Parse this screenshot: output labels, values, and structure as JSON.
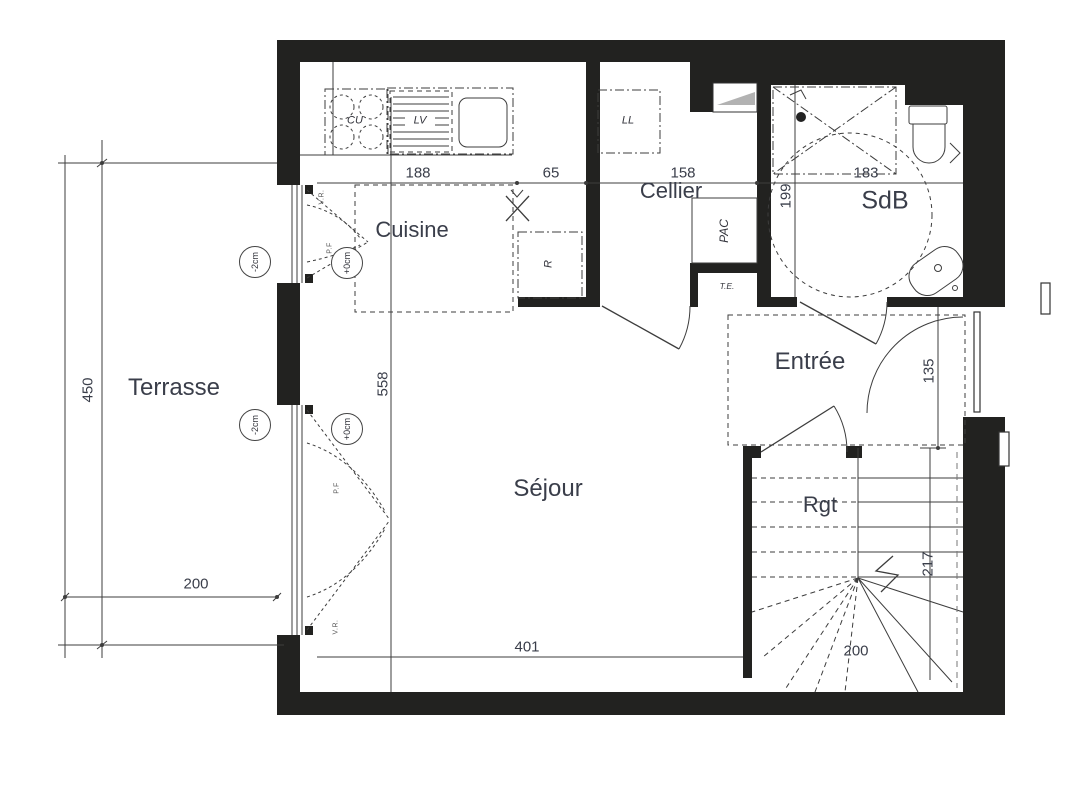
{
  "rooms": {
    "terrasse": "Terrasse",
    "cuisine": "Cuisine",
    "cellier": "Cellier",
    "sdb": "SdB",
    "sejour": "Séjour",
    "entree": "Entrée",
    "rgt": "Rgt"
  },
  "dims": {
    "k188": "188",
    "k65": "65",
    "c158": "158",
    "s183": "183",
    "s199": "199",
    "v558": "558",
    "h401": "401",
    "t450": "450",
    "t200": "200",
    "e135": "135",
    "st217": "217",
    "st200": "200"
  },
  "equipment": {
    "cu": "CU",
    "lv": "LV",
    "ll": "LL",
    "pac": "PAC",
    "r": "R",
    "te": "T.E."
  },
  "levels": {
    "minus2": "-2cm",
    "zero": "+0cm"
  },
  "windows": {
    "vr": "V.R.",
    "pf": "P.F"
  },
  "colors": {
    "wall": "#222220",
    "line": "#3d3d3d",
    "text": "#3a3e4a",
    "triangle": "#b2b2b2",
    "dash": "#555555"
  }
}
